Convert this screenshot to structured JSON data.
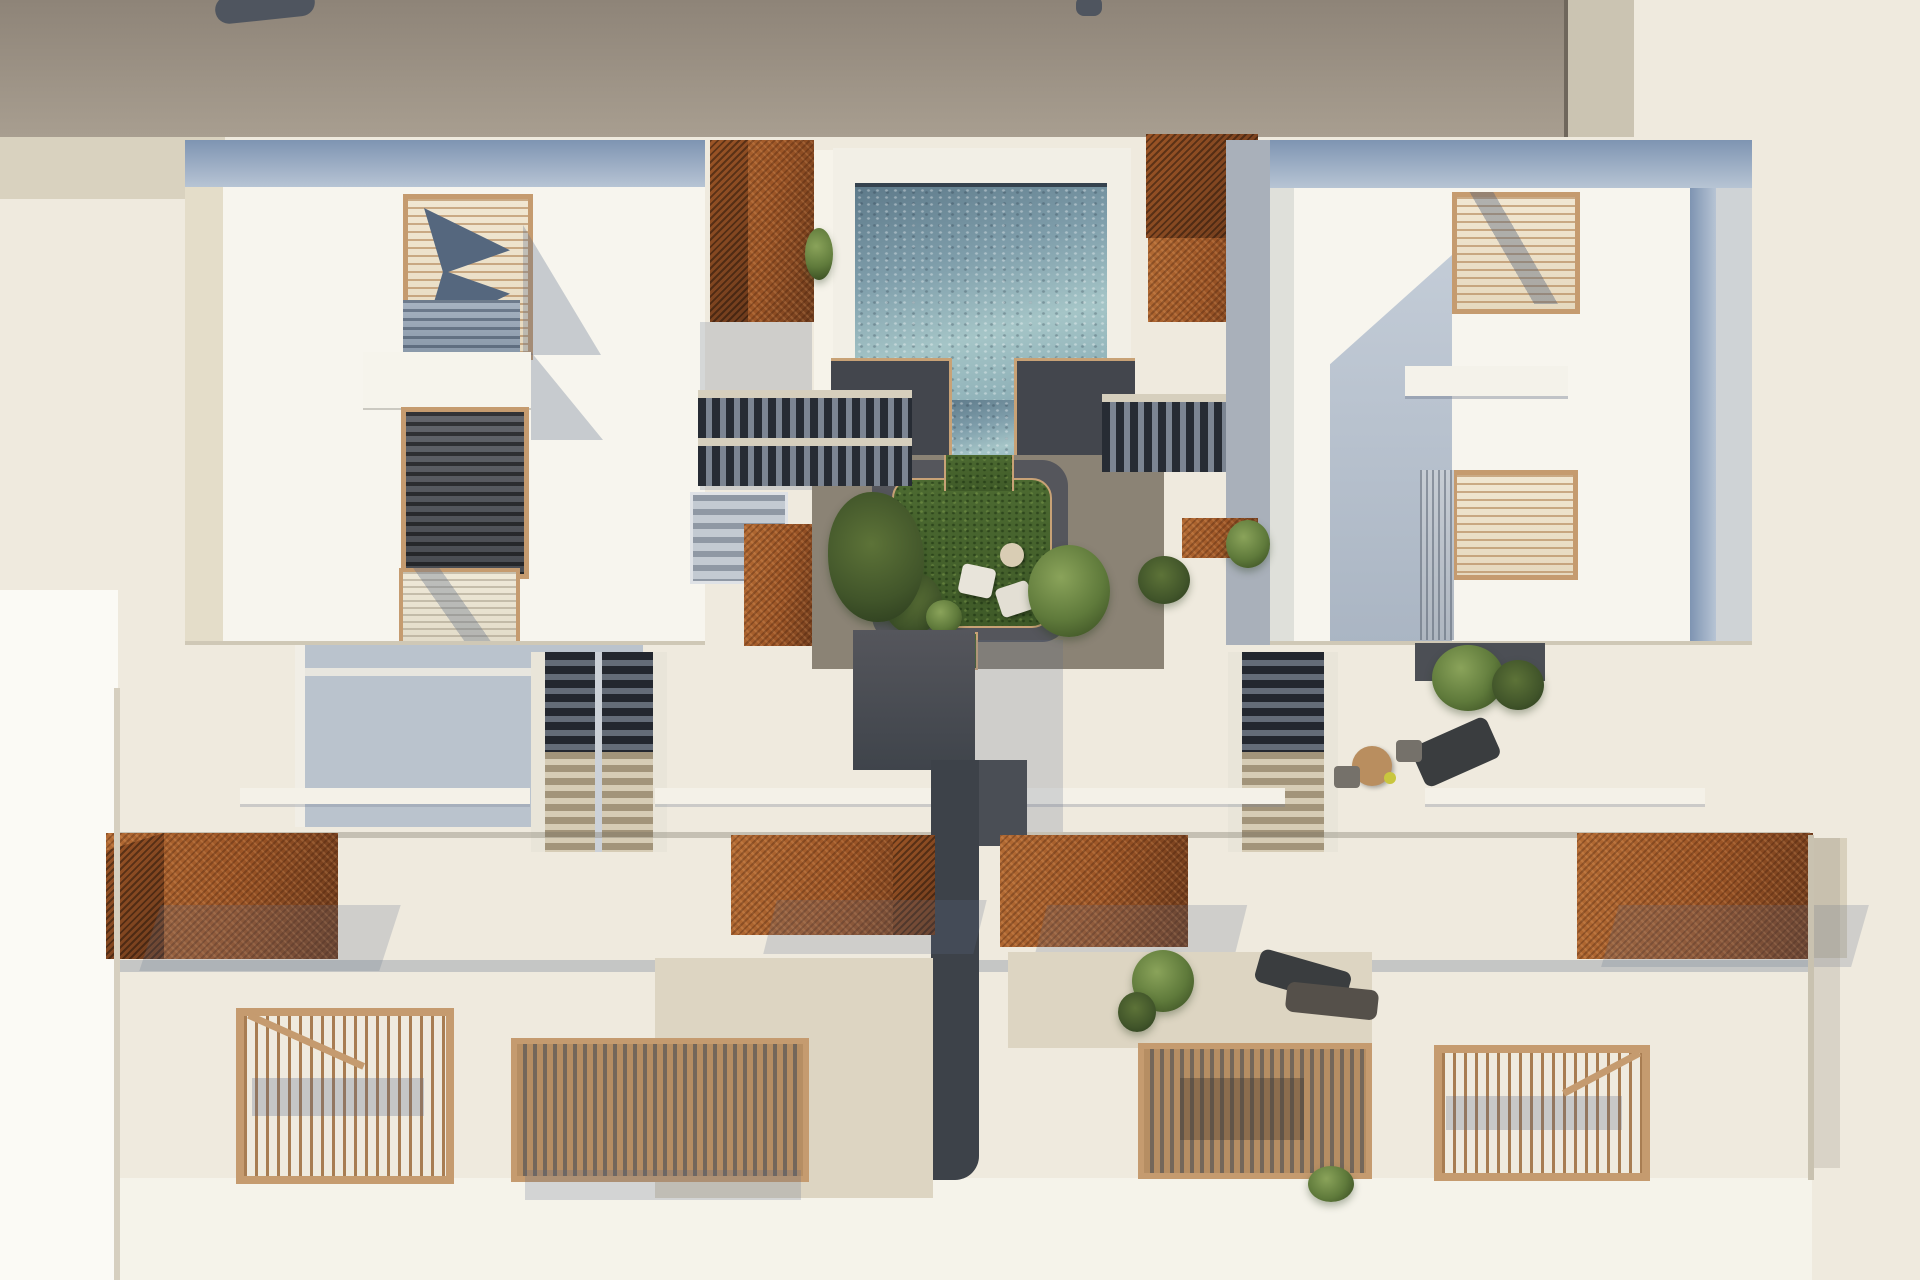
{
  "meta": {
    "type": "architectural-aerial-render",
    "description": "Top-down 3D architectural rendering of a two-block residential complex with central swimming pool, sunken lawn courtyard, twin staircases, corten-steel pergola canopies and timber-slat roof terraces",
    "view": "plan / bird's eye",
    "visible_text": []
  },
  "palette": {
    "bg": "#efeade",
    "bgWhite": "#f7f5ee",
    "paper": "#fbfaf5",
    "taupe1": "#8e8478",
    "taupe2": "#a89e90",
    "pillar": "#cbc4b2",
    "beige": "#d9d2bf",
    "roofEdge1": "#7e94b2",
    "roofEdge2": "#b7c4d4",
    "wallShadow": "#bac3cd",
    "wallGray": "#a9b0ba",
    "corten": "#9c5526",
    "cortenDark": "#6e3b1c",
    "cortenLight": "#b26a33",
    "wood": "#c59b6f",
    "woodDark": "#a87d52",
    "charcoal": "#43464d",
    "pathDark": "#55565c",
    "walkTaupe": "#8b8375",
    "travertine": "#ddd5c2",
    "green": "#5f7a3b",
    "greenDark": "#3f5426",
    "greenLight": "#8aa35a",
    "furnDark": "#3a3d3f",
    "tanLine": "#c8a276",
    "darkObj": "#4f555f"
  },
  "scene": {
    "adjacent_structures": [
      "neighboring flat roof band (taupe, top edge)",
      "light pillar at top right of roof band",
      "two small dark rooftop objects"
    ],
    "buildings": [
      {
        "name": "west-block",
        "features": [
          "blue-gray parapet band",
          "tan louvre skylight with folded open leaves",
          "blue slatted opening",
          "white balcony notch",
          "dark slatted patio roof",
          "light louvre panel at south edge"
        ]
      },
      {
        "name": "east-block",
        "features": [
          "blue-gray parapet band on top and east edge",
          "tan louvre skylights",
          "shadowed recessed patio",
          "ribbed vent panel",
          "white ledge"
        ]
      }
    ],
    "courtyard": {
      "pool": "rectangular pool with white deck and water tongue into court",
      "lawn": "cross-shaped sunken lawn with charcoal deck ring and tan curb",
      "stairs": [
        "twin flight stair west of pool",
        "flight stair east of pool",
        "broad south stair west",
        "broad south stair east",
        "switchback service stair"
      ],
      "walkway": "central dark spine walkway running south between the row houses",
      "furniture": [
        "two cream lounge chairs on lawn",
        "round side table",
        "wooden bistro table with two chairs",
        "three dark sun loungers"
      ],
      "planting": [
        "palm at pool edge",
        "courtyard shrubs",
        "terrace trees",
        "potted plants"
      ]
    },
    "south_row": {
      "canopies": [
        "corten mesh canopy far west",
        "corten canopy center-west",
        "corten canopy center-east",
        "corten mesh canopy far east"
      ],
      "terraces": [
        "open baluster railing terrace west",
        "dense timber pergola west",
        "travertine terrace",
        "dense timber pergola east",
        "open baluster railing terrace east"
      ]
    }
  }
}
